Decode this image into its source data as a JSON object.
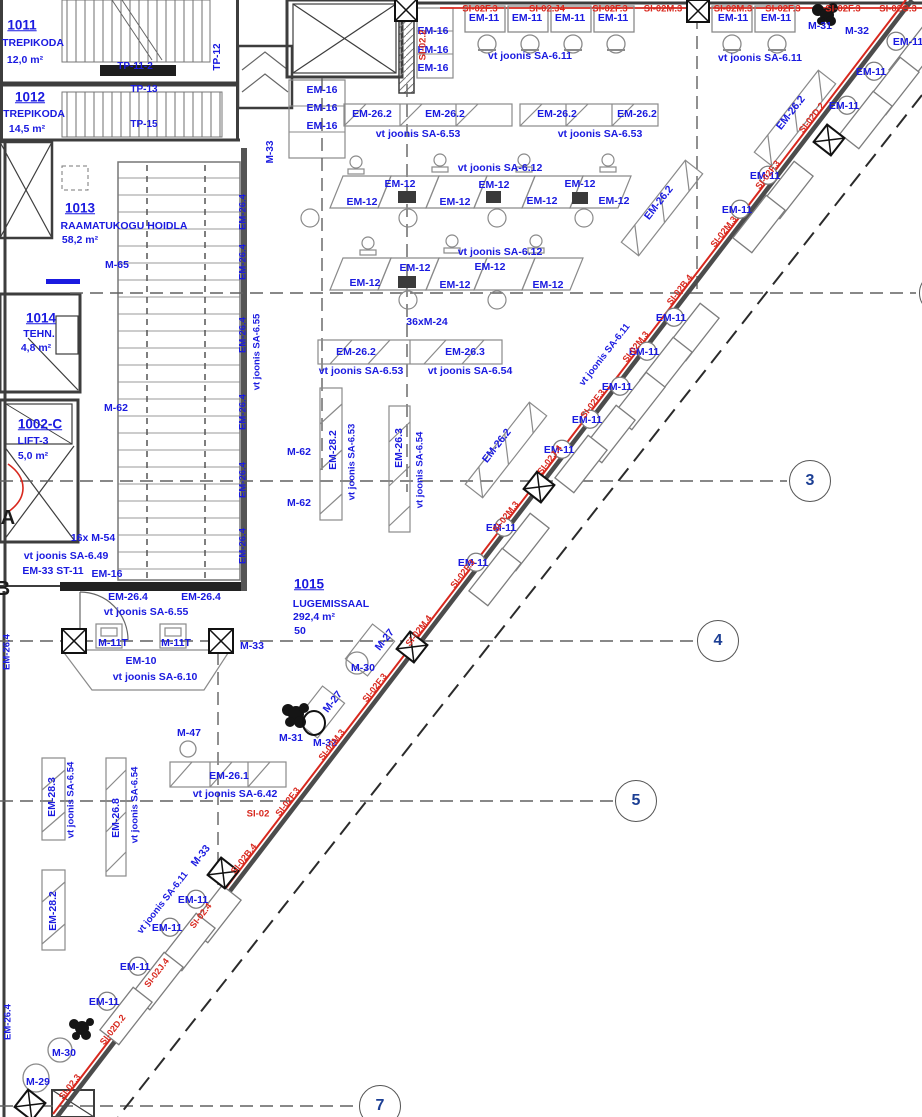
{
  "colors": {
    "b": "#1a1ae0",
    "r": "#d8281e",
    "k": "#1c1c1c",
    "n": "#1c3f94"
  },
  "grid_bubbles": [
    {
      "label": "3",
      "x": 810,
      "y": 481
    },
    {
      "label": "4",
      "x": 718,
      "y": 641
    },
    {
      "label": "5",
      "x": 636,
      "y": 801
    },
    {
      "label": "7",
      "x": 380,
      "y": 1106
    },
    {
      "label": "",
      "x": 940,
      "y": 293
    }
  ],
  "diagonal_desks": [
    {
      "x": 915,
      "y": 56
    },
    {
      "x": 893,
      "y": 86
    },
    {
      "x": 866,
      "y": 120
    },
    {
      "x": 787,
      "y": 190
    },
    {
      "x": 759,
      "y": 224
    },
    {
      "x": 693,
      "y": 332
    },
    {
      "x": 666,
      "y": 366
    },
    {
      "x": 639,
      "y": 401
    },
    {
      "x": 609,
      "y": 434
    },
    {
      "x": 581,
      "y": 464
    },
    {
      "x": 523,
      "y": 542
    },
    {
      "x": 495,
      "y": 577
    },
    {
      "x": 215,
      "y": 914
    },
    {
      "x": 189,
      "y": 942
    },
    {
      "x": 157,
      "y": 981
    },
    {
      "x": 126,
      "y": 1016
    }
  ],
  "annotations": [
    {
      "t": "1011",
      "x": 22,
      "y": 25,
      "s": 13.5,
      "u": 1
    },
    {
      "t": "TREPIKODA",
      "x": 33,
      "y": 43
    },
    {
      "t": "12,0 m²",
      "x": 25,
      "y": 60
    },
    {
      "t": "1012",
      "x": 30,
      "y": 97,
      "s": 13.5,
      "u": 1
    },
    {
      "t": "TREPIKODA",
      "x": 34,
      "y": 114
    },
    {
      "t": "14,5 m²",
      "x": 27,
      "y": 129
    },
    {
      "t": "1013",
      "x": 80,
      "y": 208,
      "s": 13.5,
      "u": 1
    },
    {
      "t": "RAAMATUKOGU HOIDLA",
      "x": 124,
      "y": 226
    },
    {
      "t": "58,2 m²",
      "x": 80,
      "y": 240
    },
    {
      "t": "1014",
      "x": 41,
      "y": 318,
      "s": 13.5,
      "u": 1
    },
    {
      "t": "TEHN.",
      "x": 39,
      "y": 334
    },
    {
      "t": "4,8 m²",
      "x": 36,
      "y": 348
    },
    {
      "t": "1002-C",
      "x": 40,
      "y": 424,
      "s": 13.5,
      "u": 1
    },
    {
      "t": "LIFT-3",
      "x": 33,
      "y": 441
    },
    {
      "t": "5,0 m²",
      "x": 33,
      "y": 456
    },
    {
      "t": "1015",
      "x": 309,
      "y": 584,
      "s": 13.5,
      "u": 1
    },
    {
      "t": "LUGEMISSAAL",
      "x": 331,
      "y": 604
    },
    {
      "t": "292,4 m²",
      "x": 314,
      "y": 617
    },
    {
      "t": "50",
      "x": 300,
      "y": 631
    },
    {
      "t": "TP-11-2",
      "x": 135,
      "y": 67,
      "s": 10
    },
    {
      "t": "TP-13",
      "x": 144,
      "y": 90,
      "s": 10
    },
    {
      "t": "TP-15",
      "x": 144,
      "y": 125,
      "s": 10
    },
    {
      "t": "TP-12",
      "x": 218,
      "y": 57,
      "r": -90,
      "s": 10
    },
    {
      "t": "M-33",
      "x": 271,
      "y": 152,
      "r": -90,
      "s": 10
    },
    {
      "t": "EM-16",
      "x": 433,
      "y": 31
    },
    {
      "t": "EM-16",
      "x": 433,
      "y": 50
    },
    {
      "t": "EM-16",
      "x": 433,
      "y": 68
    },
    {
      "t": "EM-16",
      "x": 322,
      "y": 90
    },
    {
      "t": "EM-16",
      "x": 322,
      "y": 108
    },
    {
      "t": "EM-16",
      "x": 322,
      "y": 126
    },
    {
      "t": "EM-16",
      "x": 107,
      "y": 574
    },
    {
      "t": "SI-02F.3",
      "x": 480,
      "y": 9,
      "c": "r",
      "s": 9.5
    },
    {
      "t": "SI-02.J4",
      "x": 547,
      "y": 9,
      "c": "r",
      "s": 9.5
    },
    {
      "t": "SI-02F.3",
      "x": 610,
      "y": 9,
      "c": "r",
      "s": 9.5
    },
    {
      "t": "SI-02M.3",
      "x": 663,
      "y": 9,
      "c": "r",
      "s": 9.5
    },
    {
      "t": "SI-02M.3",
      "x": 733,
      "y": 9,
      "c": "r",
      "s": 9.5
    },
    {
      "t": "SI-02F.3",
      "x": 783,
      "y": 9,
      "c": "r",
      "s": 9.5
    },
    {
      "t": "SI-02F.3",
      "x": 843,
      "y": 9,
      "c": "r",
      "s": 9.5
    },
    {
      "t": "SI-02C.3",
      "x": 898,
      "y": 9,
      "c": "r",
      "s": 9.5
    },
    {
      "t": "SI-02.2",
      "x": 423,
      "y": 45,
      "c": "r",
      "r": -90,
      "s": 9.5
    },
    {
      "t": "EM-11",
      "x": 484,
      "y": 18
    },
    {
      "t": "EM-11",
      "x": 527,
      "y": 18
    },
    {
      "t": "EM-11",
      "x": 570,
      "y": 18
    },
    {
      "t": "EM-11",
      "x": 613,
      "y": 18
    },
    {
      "t": "EM-11",
      "x": 733,
      "y": 18
    },
    {
      "t": "EM-11",
      "x": 776,
      "y": 18
    },
    {
      "t": "vt joonis SA-6.11",
      "x": 530,
      "y": 56
    },
    {
      "t": "vt joonis SA-6.11",
      "x": 760,
      "y": 58
    },
    {
      "t": "M-31",
      "x": 820,
      "y": 26
    },
    {
      "t": "M-32",
      "x": 857,
      "y": 31
    },
    {
      "t": "EM-26.2",
      "x": 372,
      "y": 114
    },
    {
      "t": "EM-26.2",
      "x": 445,
      "y": 114
    },
    {
      "t": "EM-26.2",
      "x": 557,
      "y": 114
    },
    {
      "t": "EM-26.2",
      "x": 637,
      "y": 114
    },
    {
      "t": "vt joonis SA-6.53",
      "x": 418,
      "y": 134
    },
    {
      "t": "vt joonis SA-6.53",
      "x": 600,
      "y": 134
    },
    {
      "t": "vt joonis SA-6.12",
      "x": 500,
      "y": 168
    },
    {
      "t": "EM-12",
      "x": 362,
      "y": 202
    },
    {
      "t": "EM-12",
      "x": 400,
      "y": 184
    },
    {
      "t": "EM-12",
      "x": 455,
      "y": 202
    },
    {
      "t": "EM-12",
      "x": 494,
      "y": 185
    },
    {
      "t": "EM-12",
      "x": 542,
      "y": 201
    },
    {
      "t": "EM-12",
      "x": 580,
      "y": 184
    },
    {
      "t": "EM-12",
      "x": 614,
      "y": 201
    },
    {
      "t": "vt joonis SA-6.12",
      "x": 500,
      "y": 252
    },
    {
      "t": "EM-12",
      "x": 365,
      "y": 283
    },
    {
      "t": "EM-12",
      "x": 415,
      "y": 268
    },
    {
      "t": "EM-12",
      "x": 455,
      "y": 285
    },
    {
      "t": "EM-12",
      "x": 490,
      "y": 267
    },
    {
      "t": "EM-12",
      "x": 548,
      "y": 285
    },
    {
      "t": "36xM-24",
      "x": 427,
      "y": 322
    },
    {
      "t": "EM-26.2",
      "x": 356,
      "y": 352
    },
    {
      "t": "EM-26.3",
      "x": 465,
      "y": 352
    },
    {
      "t": "vt joonis SA-6.53",
      "x": 361,
      "y": 371
    },
    {
      "t": "vt joonis SA-6.54",
      "x": 470,
      "y": 371
    },
    {
      "t": "EM-28.2",
      "x": 333,
      "y": 450,
      "r": -90
    },
    {
      "t": "vt joonis SA-6.53",
      "x": 352,
      "y": 462,
      "r": -90,
      "s": 9.5
    },
    {
      "t": "EM-26.3",
      "x": 399,
      "y": 448,
      "r": -90
    },
    {
      "t": "vt joonis SA-6.54",
      "x": 420,
      "y": 470,
      "r": -90,
      "s": 9.5
    },
    {
      "t": "EM-26.4",
      "x": 243,
      "y": 212,
      "r": -90,
      "s": 9.5
    },
    {
      "t": "EM-26.4",
      "x": 243,
      "y": 262,
      "r": -90,
      "s": 9.5
    },
    {
      "t": "EM-26.4",
      "x": 243,
      "y": 335,
      "r": -90,
      "s": 9.5
    },
    {
      "t": "EM-26.4",
      "x": 243,
      "y": 412,
      "r": -90,
      "s": 9.5
    },
    {
      "t": "EM-26.4",
      "x": 243,
      "y": 480,
      "r": -90,
      "s": 9.5
    },
    {
      "t": "EM-26.4",
      "x": 243,
      "y": 546,
      "r": -90,
      "s": 9.5
    },
    {
      "t": "vt joonis SA-6.55",
      "x": 257,
      "y": 352,
      "r": -90,
      "s": 9.5
    },
    {
      "t": "EM-26.4",
      "x": 7,
      "y": 652,
      "r": -90,
      "s": 9.5
    },
    {
      "t": "EM-26.4",
      "x": 8,
      "y": 1022,
      "r": -90,
      "s": 9.5
    },
    {
      "t": "M-65",
      "x": 117,
      "y": 265
    },
    {
      "t": "M-62",
      "x": 116,
      "y": 408
    },
    {
      "t": "M-62",
      "x": 299,
      "y": 452
    },
    {
      "t": "M-62",
      "x": 299,
      "y": 503
    },
    {
      "t": "16x M-54",
      "x": 93,
      "y": 538
    },
    {
      "t": "vt joonis SA-6.49",
      "x": 66,
      "y": 556
    },
    {
      "t": "EM-33 ST-11",
      "x": 53,
      "y": 571
    },
    {
      "t": "EM-26.4",
      "x": 128,
      "y": 597
    },
    {
      "t": "EM-26.4",
      "x": 201,
      "y": 597
    },
    {
      "t": "vt joonis SA-6.55",
      "x": 146,
      "y": 612
    },
    {
      "t": "M-11T",
      "x": 113,
      "y": 643
    },
    {
      "t": "M-11T",
      "x": 176,
      "y": 643
    },
    {
      "t": "M-33",
      "x": 252,
      "y": 646
    },
    {
      "t": "EM-10",
      "x": 141,
      "y": 661
    },
    {
      "t": "vt joonis SA-6.10",
      "x": 155,
      "y": 677
    },
    {
      "t": "A",
      "x": 8,
      "y": 518,
      "c": "k",
      "s": 20
    },
    {
      "t": "B",
      "x": 3,
      "y": 589,
      "c": "k",
      "s": 20
    },
    {
      "t": "EM-11",
      "x": 908,
      "y": 42
    },
    {
      "t": "EM-11",
      "x": 871,
      "y": 72
    },
    {
      "t": "EM-11",
      "x": 844,
      "y": 106
    },
    {
      "t": "EM-11",
      "x": 765,
      "y": 176
    },
    {
      "t": "EM-11",
      "x": 737,
      "y": 210
    },
    {
      "t": "EM-11",
      "x": 671,
      "y": 318
    },
    {
      "t": "EM-11",
      "x": 644,
      "y": 352
    },
    {
      "t": "EM-11",
      "x": 617,
      "y": 387
    },
    {
      "t": "EM-11",
      "x": 587,
      "y": 420
    },
    {
      "t": "EM-11",
      "x": 559,
      "y": 450
    },
    {
      "t": "EM-11",
      "x": 501,
      "y": 528
    },
    {
      "t": "EM-11",
      "x": 473,
      "y": 563
    },
    {
      "t": "EM-11",
      "x": 193,
      "y": 900
    },
    {
      "t": "EM-11",
      "x": 167,
      "y": 928
    },
    {
      "t": "EM-11",
      "x": 135,
      "y": 967
    },
    {
      "t": "EM-11",
      "x": 104,
      "y": 1002
    },
    {
      "t": "EM-26.2",
      "x": 791,
      "y": 113,
      "r": -52
    },
    {
      "t": "EM-26.2",
      "x": 659,
      "y": 203,
      "r": -52
    },
    {
      "t": "EM-26.2",
      "x": 497,
      "y": 446,
      "r": -52
    },
    {
      "t": "vt joonis SA-6.11",
      "x": 605,
      "y": 355,
      "r": -52,
      "s": 9.5
    },
    {
      "t": "vt joonis SA-6.11",
      "x": 163,
      "y": 903,
      "r": -52,
      "s": 9.5
    },
    {
      "t": "M-27",
      "x": 385,
      "y": 640,
      "r": -52
    },
    {
      "t": "M-27",
      "x": 333,
      "y": 702,
      "r": -52
    },
    {
      "t": "M-30",
      "x": 363,
      "y": 668
    },
    {
      "t": "M-31",
      "x": 291,
      "y": 738
    },
    {
      "t": "M-32",
      "x": 325,
      "y": 743
    },
    {
      "t": "M-47",
      "x": 189,
      "y": 733
    },
    {
      "t": "EM-26.1",
      "x": 229,
      "y": 776
    },
    {
      "t": "vt joonis SA-6.42",
      "x": 235,
      "y": 794
    },
    {
      "t": "SI-02",
      "x": 258,
      "y": 814,
      "c": "r",
      "s": 9.5
    },
    {
      "t": "M-33",
      "x": 201,
      "y": 856,
      "r": -52
    },
    {
      "t": "M-30",
      "x": 64,
      "y": 1053
    },
    {
      "t": "M-29",
      "x": 38,
      "y": 1082
    },
    {
      "t": "EM-28.3",
      "x": 52,
      "y": 797,
      "r": -90
    },
    {
      "t": "vt joonis SA-6.54",
      "x": 71,
      "y": 800,
      "r": -90,
      "s": 9.5
    },
    {
      "t": "EM-26.8",
      "x": 116,
      "y": 818,
      "r": -90
    },
    {
      "t": "vt joonis SA-6.54",
      "x": 135,
      "y": 805,
      "r": -90,
      "s": 9.5
    },
    {
      "t": "EM-28.2",
      "x": 53,
      "y": 911,
      "r": -90
    },
    {
      "t": "SI-02D.2",
      "x": 812,
      "y": 118,
      "c": "r",
      "r": -52,
      "s": 9
    },
    {
      "t": "SI-02F.3",
      "x": 768,
      "y": 175,
      "c": "r",
      "r": -52,
      "s": 9
    },
    {
      "t": "SI-02M.3",
      "x": 724,
      "y": 232,
      "c": "r",
      "r": -52,
      "s": 9
    },
    {
      "t": "SI-02B.4",
      "x": 680,
      "y": 290,
      "c": "r",
      "r": -52,
      "s": 9
    },
    {
      "t": "SI-02M.3",
      "x": 636,
      "y": 347,
      "c": "r",
      "r": -52,
      "s": 9
    },
    {
      "t": "SI-02F.3",
      "x": 593,
      "y": 404,
      "c": "r",
      "r": -52,
      "s": 9
    },
    {
      "t": "SI-02J.4",
      "x": 550,
      "y": 460,
      "c": "r",
      "r": -52,
      "s": 9
    },
    {
      "t": "SI-02M.3",
      "x": 506,
      "y": 517,
      "c": "r",
      "r": -52,
      "s": 9
    },
    {
      "t": "SI-02F.3",
      "x": 463,
      "y": 574,
      "c": "r",
      "r": -52,
      "s": 9
    },
    {
      "t": "SI-02M.4",
      "x": 419,
      "y": 631,
      "c": "r",
      "r": -52,
      "s": 9
    },
    {
      "t": "SI-02F.3",
      "x": 375,
      "y": 688,
      "c": "r",
      "r": -52,
      "s": 9
    },
    {
      "t": "SI-02M.3",
      "x": 332,
      "y": 745,
      "c": "r",
      "r": -52,
      "s": 9
    },
    {
      "t": "SI-02F.3",
      "x": 288,
      "y": 802,
      "c": "r",
      "r": -52,
      "s": 9
    },
    {
      "t": "SI-02B.4",
      "x": 244,
      "y": 859,
      "c": "r",
      "r": -52,
      "s": 9
    },
    {
      "t": "SI-02.4",
      "x": 201,
      "y": 916,
      "c": "r",
      "r": -52,
      "s": 9
    },
    {
      "t": "SI-02J.4",
      "x": 157,
      "y": 973,
      "c": "r",
      "r": -52,
      "s": 9
    },
    {
      "t": "SI-02D.2",
      "x": 113,
      "y": 1030,
      "c": "r",
      "r": -52,
      "s": 9
    },
    {
      "t": "SI-02.3",
      "x": 70,
      "y": 1087,
      "c": "r",
      "r": -52,
      "s": 9
    }
  ]
}
